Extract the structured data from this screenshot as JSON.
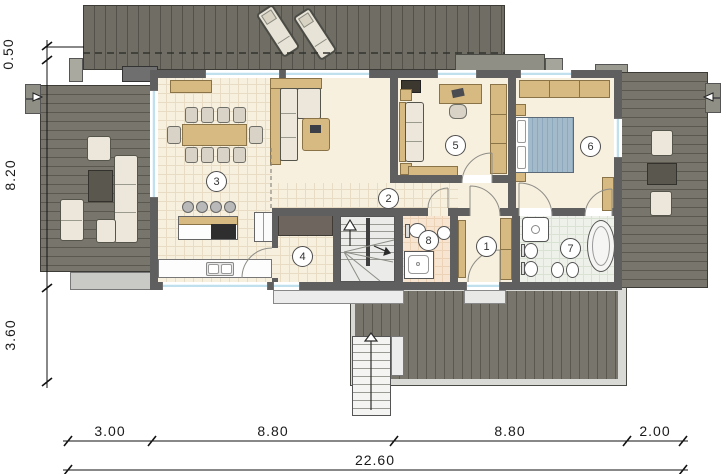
{
  "title": "single-storey house floor plan",
  "rooms": [
    {
      "number": "1"
    },
    {
      "number": "2"
    },
    {
      "number": "3"
    },
    {
      "number": "4"
    },
    {
      "number": "5"
    },
    {
      "number": "6"
    },
    {
      "number": "7"
    },
    {
      "number": "8"
    }
  ],
  "dimensions": {
    "left": [
      {
        "label": "0.50"
      },
      {
        "label": "8.20"
      },
      {
        "label": "3.60"
      }
    ],
    "bottom": [
      {
        "label": "3.00"
      },
      {
        "label": "8.80"
      },
      {
        "label": "8.80"
      },
      {
        "label": "2.00"
      }
    ],
    "total": {
      "label": "22.60"
    }
  },
  "colors": {
    "deck": "#77756c",
    "deckline": "#5a584f",
    "deck2": "#706e64",
    "deckline2": "#53514a",
    "wall": "#5f5f5f",
    "floor": "#f8f0de",
    "tile": "#e8dcc4",
    "bath7": "#eef1e9",
    "bath7line": "#d9e2d3",
    "bath8": "#f7e5d1",
    "bath8line": "#ecd3b8",
    "winblue": "#bfe0ec",
    "wood": "#d7b982",
    "woodline": "#8a7347",
    "cushion": "#ece7da",
    "cushionline": "#55554c",
    "mattress": "#a3bacb",
    "concrete": "#c9c9c6",
    "ink": "#1a1a1a"
  }
}
